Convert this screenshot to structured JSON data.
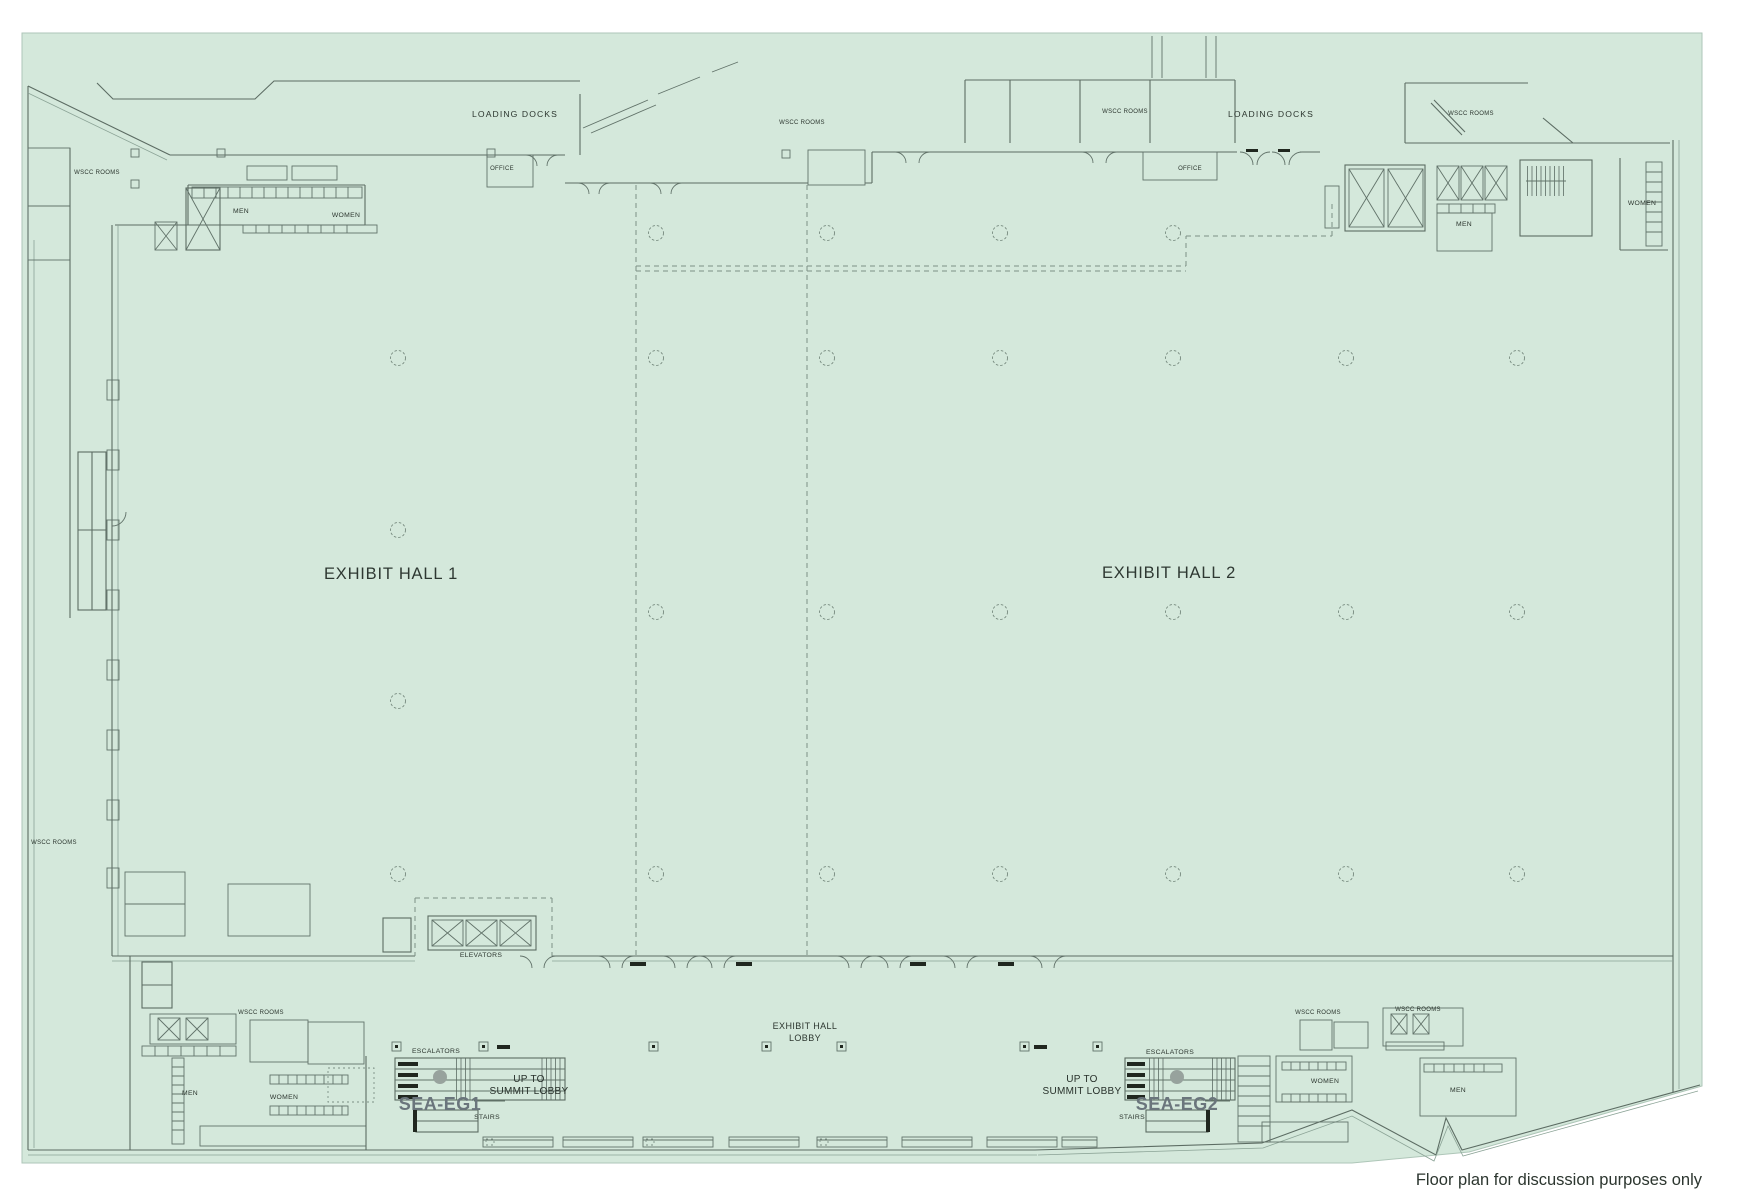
{
  "floor_plan": {
    "hall1_label": "EXHIBIT HALL 1",
    "hall2_label": "EXHIBIT HALL 2",
    "lobby_label_line1": "EXHIBIT HALL",
    "lobby_label_line2": "LOBBY",
    "loading_docks_label": "LOADING DOCKS",
    "wscc_rooms_label": "WSCC ROOMS",
    "office_label": "OFFICE",
    "men_label": "MEN",
    "women_label": "WOMEN",
    "elevators_label": "ELEVATORS",
    "escalators_label": "ESCALATORS",
    "stairs_label": "STAIRS",
    "up_to_label": "UP TO",
    "summit_lobby_label": "SUMMIT LOBBY",
    "stair_core_1": "SEA-EG1",
    "stair_core_2": "SEA-EG2",
    "disclaimer": "Floor plan for discussion purposes only",
    "colors": {
      "floor": "#d4e8db",
      "wall": "#5c6c63",
      "label_text": "#2c362f",
      "stair_core_text": "#6a757c",
      "disclaimer_red": "#d13a2e"
    }
  }
}
